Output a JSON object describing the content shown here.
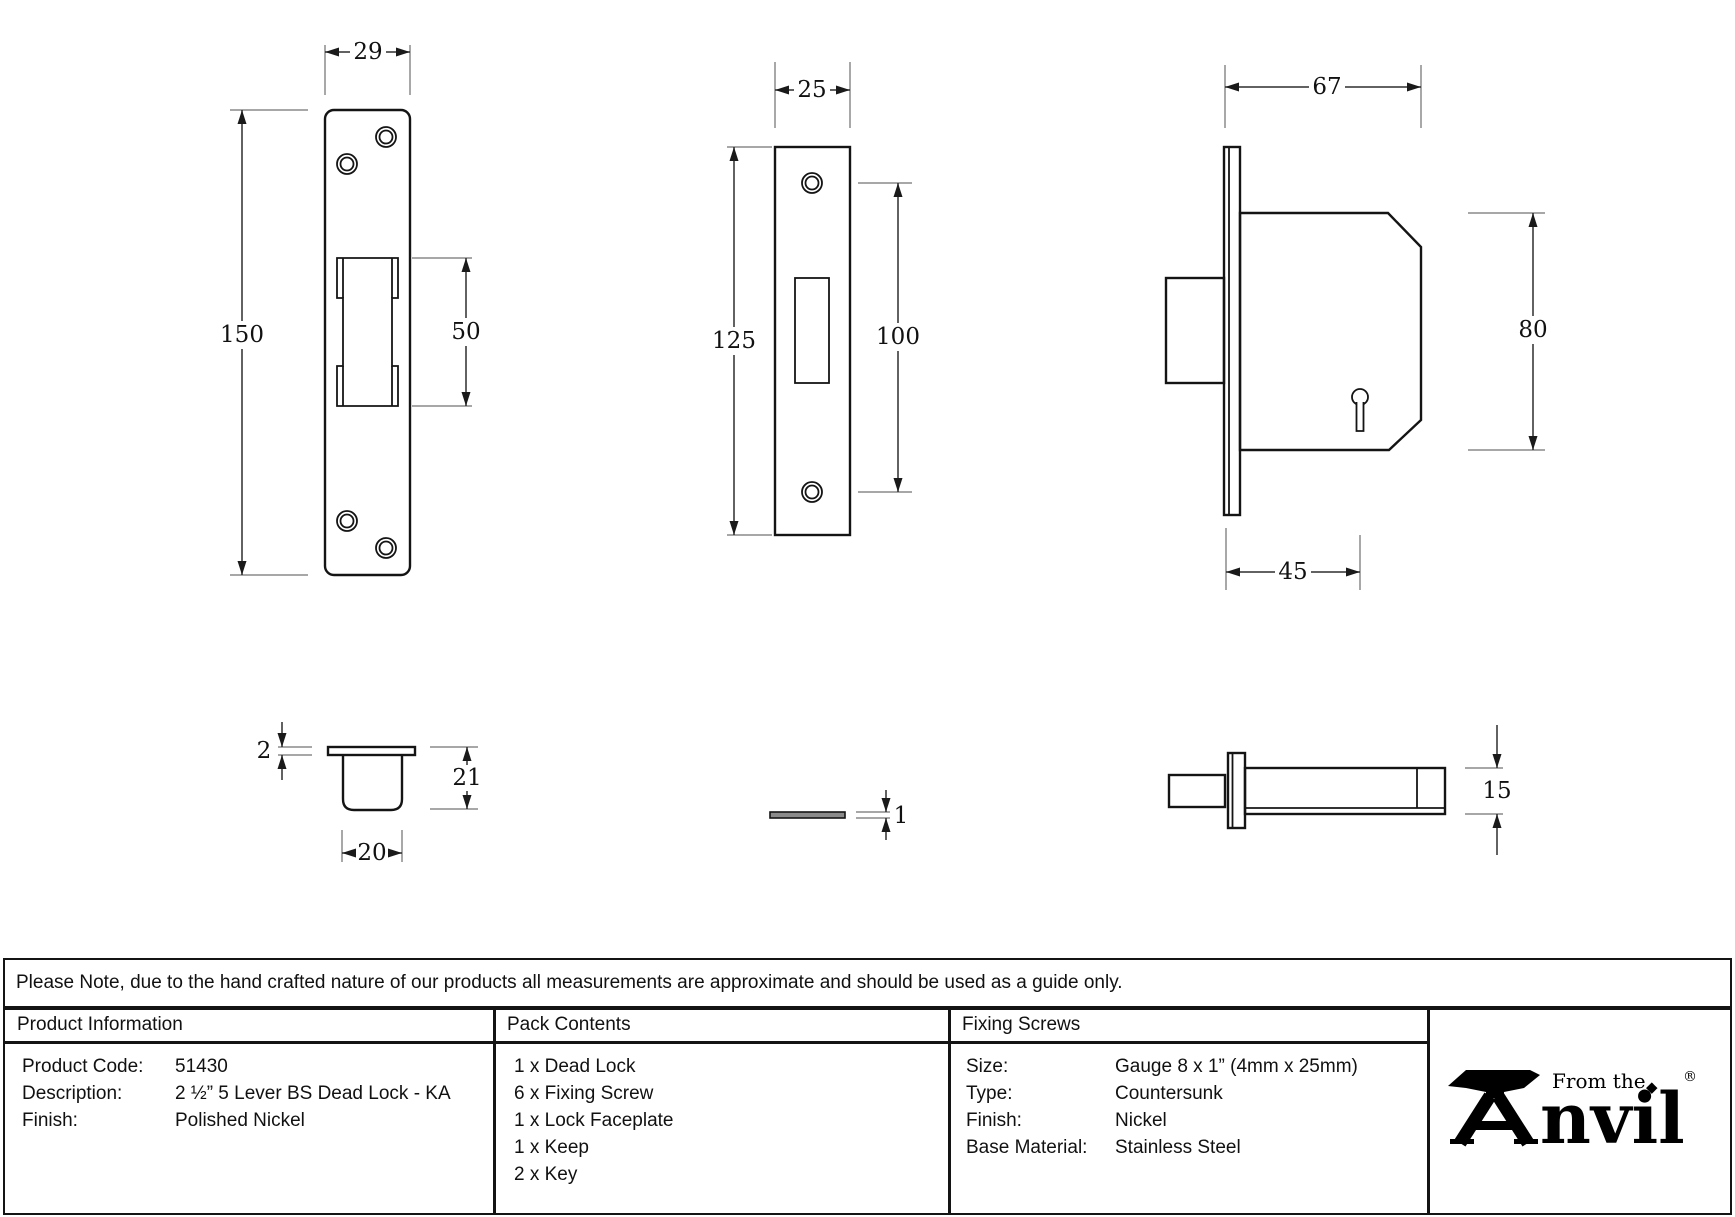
{
  "note": "Please Note, due to the hand crafted nature of our products all measurements are approximate and should be used as a guide only.",
  "drawings": {
    "keep_front": {
      "width": "29",
      "height": "150",
      "slot_height": "50"
    },
    "faceplate_front": {
      "width": "25",
      "height": "125",
      "hole_spacing": "100"
    },
    "lock_front": {
      "width": "67",
      "height": "80",
      "backset": "45"
    },
    "keep_side": {
      "lip": "2",
      "depth": "21",
      "width": "20"
    },
    "faceplate_side": {
      "thickness": "1"
    },
    "lock_side": {
      "thickness": "15"
    }
  },
  "product_information": {
    "header": "Product Information",
    "rows": [
      {
        "label": "Product Code:",
        "value": "51430"
      },
      {
        "label": "Description:",
        "value": "2 ½” 5 Lever BS Dead Lock - KA"
      },
      {
        "label": "Finish:",
        "value": "Polished Nickel"
      }
    ]
  },
  "pack_contents": {
    "header": "Pack Contents",
    "items": [
      "1 x Dead Lock",
      "6 x Fixing Screw",
      "1 x Lock Faceplate",
      "1 x Keep",
      "2 x Key"
    ]
  },
  "fixing_screws": {
    "header": "Fixing Screws",
    "rows": [
      {
        "label": "Size:",
        "value": "Gauge 8 x 1” (4mm x 25mm)"
      },
      {
        "label": "Type:",
        "value": "Countersunk"
      },
      {
        "label": "Finish:",
        "value": "Nickel"
      },
      {
        "label": "Base Material:",
        "value": "Stainless Steel"
      }
    ]
  },
  "brand": {
    "tagline": "From the",
    "name": "Anvil",
    "name_rest": "nvil",
    "diamond": "◆",
    "registered": "®"
  }
}
